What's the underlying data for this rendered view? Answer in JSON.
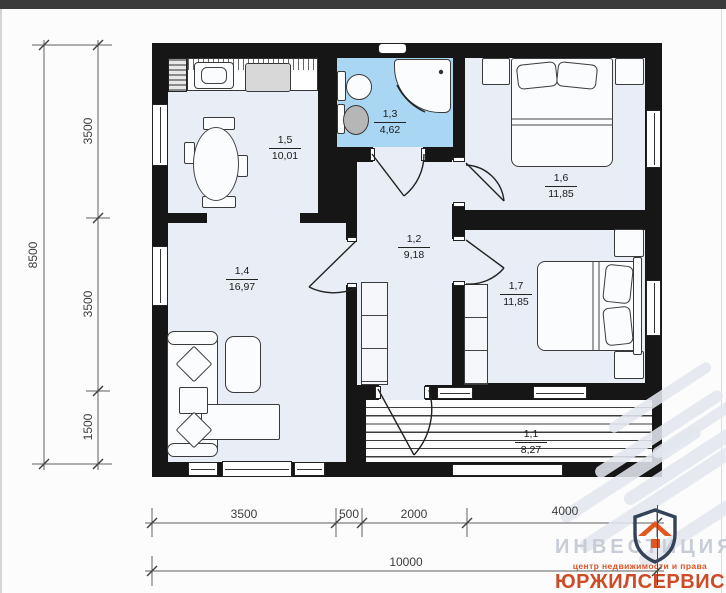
{
  "page": {
    "type": "floor-plan"
  },
  "rooms": {
    "kitchen": {
      "num": "1,5",
      "area": "10,01"
    },
    "bathroom": {
      "num": "1,3",
      "area": "4,62"
    },
    "bedroom_top": {
      "num": "1,6",
      "area": "11,85"
    },
    "hallway": {
      "num": "1,2",
      "area": "9,18"
    },
    "living_room": {
      "num": "1,4",
      "area": "16,97"
    },
    "bedroom_bottom": {
      "num": "1,7",
      "area": "11,85"
    },
    "terrace": {
      "num": "1,1",
      "area": "8,27"
    }
  },
  "dimensions": {
    "total_height": "8500",
    "left_segments": [
      "3500",
      "3500",
      "1500"
    ],
    "bottom_segments": [
      "3500",
      "500",
      "2000",
      "4000"
    ],
    "total_width": "10000"
  },
  "watermark": {
    "brand": "ИНВЕСТИЦИЯ",
    "tagline": "центр недвижимости и права",
    "company": "ЮРЖИЛСЕРВИС"
  },
  "colors": {
    "wall": "#161616",
    "room_fill": "#e9edf5",
    "bathroom_fill": "#a9d6f2",
    "logo_navy": "#344258",
    "logo_orange": "#e2571f",
    "company_red": "#cf4b28",
    "watermark_gray": "#c7ccd6"
  }
}
